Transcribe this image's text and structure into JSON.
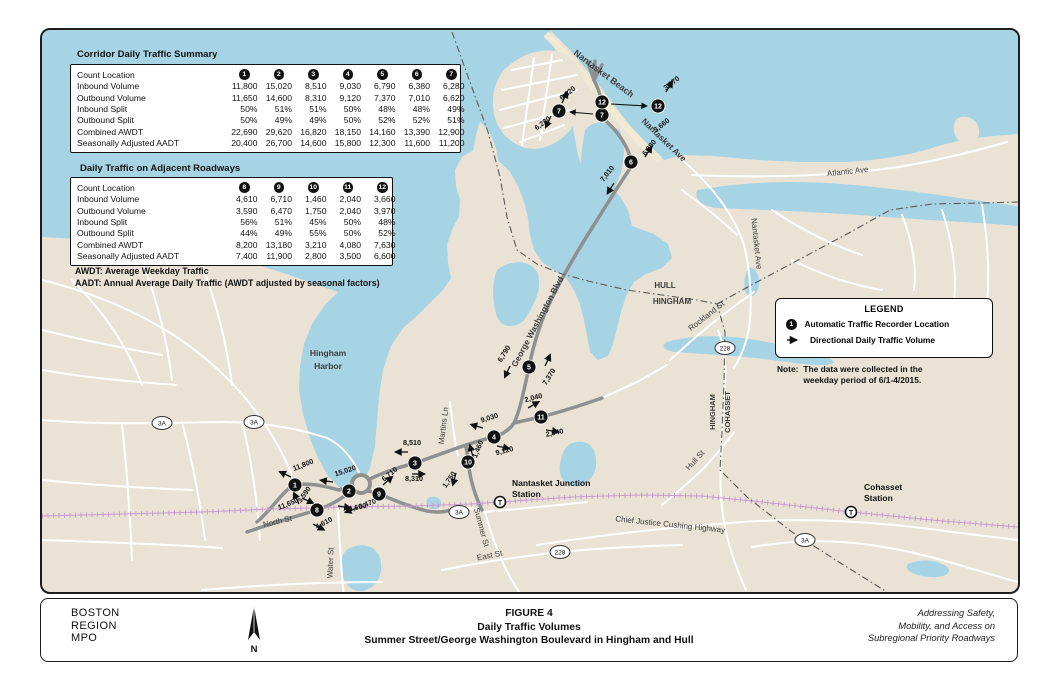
{
  "figure": {
    "agency_lines": [
      "BOSTON",
      "REGION",
      "MPO"
    ],
    "number": "FIGURE 4",
    "title": "Daily Traffic Volumes",
    "subtitle": "Summer Street/George Washington Boulevard in Hingham and Hull",
    "tagline_lines": [
      "Addressing Safety,",
      "Mobility, and Access on",
      "Subregional Priority Roadways"
    ],
    "north_label": "N"
  },
  "tables": [
    {
      "title": "Corridor Daily Traffic Summary",
      "row_header": "Count Location",
      "locations": [
        "1",
        "2",
        "3",
        "4",
        "5",
        "6",
        "7"
      ],
      "rows": [
        {
          "label": "Inbound Volume",
          "values": [
            "11,800",
            "15,020",
            "8,510",
            "9,030",
            "6,790",
            "6,380",
            "6,280"
          ]
        },
        {
          "label": "Outbound Volume",
          "values": [
            "11,650",
            "14,600",
            "8,310",
            "9,120",
            "7,370",
            "7,010",
            "6,620"
          ]
        },
        {
          "label": "Inbound Split",
          "values": [
            "50%",
            "51%",
            "51%",
            "50%",
            "48%",
            "48%",
            "49%"
          ]
        },
        {
          "label": "Outbound Split",
          "values": [
            "50%",
            "49%",
            "49%",
            "50%",
            "52%",
            "52%",
            "51%"
          ]
        },
        {
          "label": "Combined AWDT",
          "values": [
            "22,690",
            "29,620",
            "16,820",
            "18,150",
            "14,160",
            "13,390",
            "12,900"
          ]
        },
        {
          "label": "Seasonally Adjusted AADT",
          "values": [
            "20,400",
            "26,700",
            "14,600",
            "15,800",
            "12,300",
            "11,600",
            "11,200"
          ]
        }
      ]
    },
    {
      "title": "Daily Traffic on Adjacent Roadways",
      "row_header": "Count Location",
      "locations": [
        "8",
        "9",
        "10",
        "11",
        "12"
      ],
      "rows": [
        {
          "label": "Inbound Volume",
          "values": [
            "4,610",
            "6,710",
            "1,460",
            "2,040",
            "3,660"
          ]
        },
        {
          "label": "Outbound Volume",
          "values": [
            "3,590",
            "6,470",
            "1,750",
            "2,040",
            "3,970"
          ]
        },
        {
          "label": "Inbound Split",
          "values": [
            "56%",
            "51%",
            "45%",
            "50%",
            "48%"
          ]
        },
        {
          "label": "Outbound Split",
          "values": [
            "44%",
            "49%",
            "55%",
            "50%",
            "52%"
          ]
        },
        {
          "label": "Combined AWDT",
          "values": [
            "8,200",
            "13,180",
            "3,210",
            "4,080",
            "7,630"
          ]
        },
        {
          "label": "Seasonally Adjusted AADT",
          "values": [
            "7,400",
            "11,900",
            "2,800",
            "3,500",
            "6,600"
          ]
        }
      ]
    }
  ],
  "footnotes": [
    "AWDT: Average Weekday Traffic",
    "AADT: Annual Average Daily Traffic (AWDT adjusted by seasonal factors)"
  ],
  "legend": {
    "title": "LEGEND",
    "items": [
      {
        "icon": "traffic-recorder-marker-icon",
        "icon_char": "1",
        "label": "Automatic Traffic Recorder Location"
      },
      {
        "icon": "direction-arrow-icon",
        "label": "Directional Daily Traffic Volume"
      }
    ],
    "note_label": "Note:",
    "note_lines": [
      "The data were collected in the",
      "weekday period of 6/1-4/2015."
    ]
  },
  "map": {
    "colors": {
      "water": "#a7d4e4",
      "land": "#eae3d5",
      "road_major": "#8f9090",
      "road_minor": "#ffffff",
      "railroad": "#c79ed0",
      "marker": "#111111",
      "beach": "#f1e9d1"
    },
    "markers": [
      {
        "id": "1",
        "x": 253,
        "y": 455
      },
      {
        "id": "2",
        "x": 307,
        "y": 461
      },
      {
        "id": "3",
        "x": 373,
        "y": 433
      },
      {
        "id": "4",
        "x": 452,
        "y": 407
      },
      {
        "id": "5",
        "x": 487,
        "y": 337
      },
      {
        "id": "6",
        "x": 589,
        "y": 132
      },
      {
        "id": "7",
        "x": 560,
        "y": 85
      },
      {
        "id": "8",
        "x": 275,
        "y": 480
      },
      {
        "id": "9",
        "x": 337,
        "y": 464
      },
      {
        "id": "10",
        "x": 426,
        "y": 432
      },
      {
        "id": "11",
        "x": 499,
        "y": 387
      },
      {
        "id": "12",
        "x": 560,
        "y": 72
      }
    ],
    "callout_markers": [
      {
        "id": "7",
        "x": 517,
        "y": 81
      },
      {
        "id": "12",
        "x": 616,
        "y": 76
      }
    ],
    "volume_labels": [
      {
        "text": "11,800",
        "x": 262,
        "y": 437,
        "rot": -22,
        "arrow": {
          "x": 249,
          "y": 447,
          "a": 205
        }
      },
      {
        "text": "11,650",
        "x": 247,
        "y": 476,
        "rot": -22,
        "arrow": {
          "x": 260,
          "y": 468,
          "a": 25
        }
      },
      {
        "text": "15,020",
        "x": 304,
        "y": 443,
        "rot": -18,
        "arrow": {
          "x": 291,
          "y": 452,
          "a": 188
        }
      },
      {
        "text": "14,600",
        "x": 314,
        "y": 480,
        "rot": -12,
        "arrow": {
          "x": 296,
          "y": 476,
          "a": 8
        }
      },
      {
        "text": "8,510",
        "x": 370,
        "y": 415,
        "rot": 0,
        "arrow": {
          "x": 366,
          "y": 422,
          "a": 180
        }
      },
      {
        "text": "8,310",
        "x": 372,
        "y": 451,
        "rot": 0,
        "arrow": {
          "x": 370,
          "y": 444,
          "a": 0
        }
      },
      {
        "text": "9,030",
        "x": 448,
        "y": 390,
        "rot": -18,
        "arrow": {
          "x": 441,
          "y": 398,
          "a": 196
        }
      },
      {
        "text": "9,120",
        "x": 463,
        "y": 423,
        "rot": -15,
        "arrow": {
          "x": 455,
          "y": 416,
          "a": 12
        }
      },
      {
        "text": "6,790",
        "x": 464,
        "y": 325,
        "rot": -58,
        "arrow": {
          "x": 468,
          "y": 336,
          "a": 115
        }
      },
      {
        "text": "7,370",
        "x": 509,
        "y": 348,
        "rot": -58,
        "arrow": {
          "x": 503,
          "y": 336,
          "a": 295
        }
      },
      {
        "text": "7,010",
        "x": 567,
        "y": 145,
        "rot": -52,
        "arrow": {
          "x": 572,
          "y": 153,
          "a": 122
        }
      },
      {
        "text": "6,380",
        "x": 609,
        "y": 119,
        "rot": -52,
        "arrow": {
          "x": 603,
          "y": 127,
          "a": 302
        }
      },
      {
        "text": "6,620",
        "x": 527,
        "y": 65,
        "rot": -38,
        "arrow": {
          "x": 520,
          "y": 73,
          "a": 295
        }
      },
      {
        "text": "6,280",
        "x": 502,
        "y": 95,
        "rot": -38,
        "arrow": {
          "x": 509,
          "y": 86,
          "a": 115
        }
      },
      {
        "text": "3,970",
        "x": 631,
        "y": 55,
        "rot": -38,
        "arrow": {
          "x": 624,
          "y": 62,
          "a": 300
        }
      },
      {
        "text": "3,660",
        "x": 621,
        "y": 97,
        "rot": -38,
        "arrow": null
      },
      {
        "text": "3,590",
        "x": 264,
        "y": 466,
        "rot": -55,
        "arrow": {
          "x": 257,
          "y": 474,
          "a": 245
        }
      },
      {
        "text": "4,610",
        "x": 283,
        "y": 495,
        "rot": -28,
        "arrow": {
          "x": 271,
          "y": 494,
          "a": 28
        }
      },
      {
        "text": "6,710",
        "x": 349,
        "y": 446,
        "rot": -40,
        "arrow": {
          "x": 341,
          "y": 455,
          "a": 318
        }
      },
      {
        "text": "6,470",
        "x": 326,
        "y": 476,
        "rot": -20,
        "arrow": {
          "x": 315,
          "y": 478,
          "a": 160
        }
      },
      {
        "text": "1,460",
        "x": 438,
        "y": 420,
        "rot": -68,
        "arrow": {
          "x": 431,
          "y": 427,
          "a": 255
        }
      },
      {
        "text": "1,750",
        "x": 409,
        "y": 451,
        "rot": -55,
        "arrow": {
          "x": 414,
          "y": 443,
          "a": 105
        }
      },
      {
        "text": "2,040",
        "x": 492,
        "y": 370,
        "rot": -15,
        "arrow": {
          "x": 486,
          "y": 378,
          "a": 330
        }
      },
      {
        "text": "2,040",
        "x": 513,
        "y": 405,
        "rot": -12,
        "arrow": {
          "x": 504,
          "y": 400,
          "a": 8
        }
      }
    ],
    "road_labels": [
      {
        "text": "Nantasket Beach",
        "x": 560,
        "y": 46,
        "rot": 37,
        "size": 9,
        "bold": true
      },
      {
        "text": "Nantasket Ave",
        "x": 620,
        "y": 112,
        "rot": 44,
        "size": 8.5,
        "bold": true
      },
      {
        "text": "Nantasket Ave",
        "x": 712,
        "y": 214,
        "rot": 84,
        "size": 8,
        "bold": false
      },
      {
        "text": "Atlantic Ave",
        "x": 806,
        "y": 144,
        "rot": -6,
        "size": 8,
        "bold": false
      },
      {
        "text": "George Washington Blvd",
        "x": 498,
        "y": 293,
        "rot": -62,
        "size": 8.5,
        "bold": true
      },
      {
        "text": "Rockland St",
        "x": 666,
        "y": 288,
        "rot": -38,
        "size": 8,
        "bold": false
      },
      {
        "text": "Hull St",
        "x": 655,
        "y": 432,
        "rot": -48,
        "size": 8,
        "bold": false
      },
      {
        "text": "Martins Ln",
        "x": 404,
        "y": 396,
        "rot": -83,
        "size": 8,
        "bold": false
      },
      {
        "text": "Summer St",
        "x": 437,
        "y": 498,
        "rot": 75,
        "size": 8,
        "bold": false
      },
      {
        "text": "Water St",
        "x": 291,
        "y": 533,
        "rot": -88,
        "size": 8,
        "bold": false
      },
      {
        "text": "North St",
        "x": 236,
        "y": 494,
        "rot": -13,
        "size": 8,
        "bold": false
      },
      {
        "text": "East St",
        "x": 448,
        "y": 528,
        "rot": -11,
        "size": 8,
        "bold": false
      },
      {
        "text": "Chief Justice Cushing Highway",
        "x": 628,
        "y": 497,
        "rot": 6,
        "size": 8,
        "bold": false
      },
      {
        "text": "HULL",
        "x": 623,
        "y": 258,
        "rot": 0,
        "size": 8,
        "bold": true
      },
      {
        "text": "HINGHAM",
        "x": 630,
        "y": 274,
        "rot": 0,
        "size": 8,
        "bold": true
      },
      {
        "text": "HINGHAM",
        "x": 673,
        "y": 382,
        "rot": -90,
        "size": 7.5,
        "bold": true
      },
      {
        "text": "COHASSET",
        "x": 688,
        "y": 382,
        "rot": -90,
        "size": 7.5,
        "bold": true
      },
      {
        "text": "Hingham",
        "x": 286,
        "y": 326,
        "rot": 0,
        "size": 8.5,
        "bold": true
      },
      {
        "text": "Harbor",
        "x": 286,
        "y": 339,
        "rot": 0,
        "size": 8.5,
        "bold": true
      }
    ],
    "shields": [
      {
        "text": "3A",
        "x": 120,
        "y": 393
      },
      {
        "text": "3A",
        "x": 212,
        "y": 392
      },
      {
        "text": "3A",
        "x": 417,
        "y": 482
      },
      {
        "text": "3A",
        "x": 763,
        "y": 510
      },
      {
        "text": "228",
        "x": 683,
        "y": 318
      },
      {
        "text": "228",
        "x": 518,
        "y": 522
      }
    ],
    "stations": [
      {
        "lines": [
          "Nantasket Junction",
          "Station"
        ],
        "x": 458,
        "y": 472,
        "tx": 470,
        "ty": 456
      },
      {
        "lines": [
          "Cohasset",
          "Station"
        ],
        "x": 809,
        "y": 482,
        "tx": 822,
        "ty": 460
      }
    ]
  }
}
